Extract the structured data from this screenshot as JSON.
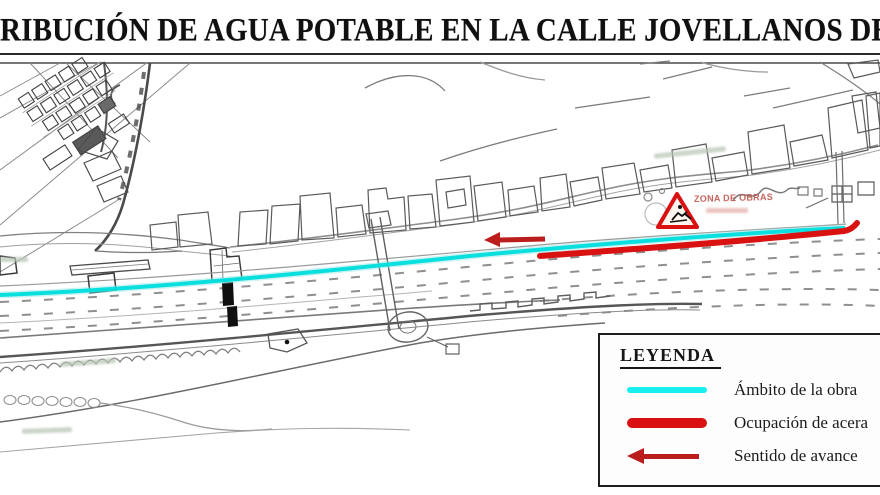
{
  "title": {
    "text": "RIBUCIÓN DE AGUA POTABLE EN LA CALLE JOVELLANOS DE"
  },
  "map": {
    "works_sign": {
      "label": "ZONA DE OBRAS"
    }
  },
  "legend": {
    "title": "LEYENDA",
    "items": [
      {
        "id": "work-extent",
        "label": "Ámbito de la obra"
      },
      {
        "id": "sidewalk-occupation",
        "label": "Ocupación de acera"
      },
      {
        "id": "advance-direction",
        "label": "Sentido de avance"
      }
    ]
  },
  "theme": {
    "cyan": "#00dede",
    "cyan-halo": "#8fe3df",
    "legend-cyan": "#17efef",
    "red": "#d91111",
    "red-dark": "#bb1d1d",
    "ink": "#141414"
  }
}
